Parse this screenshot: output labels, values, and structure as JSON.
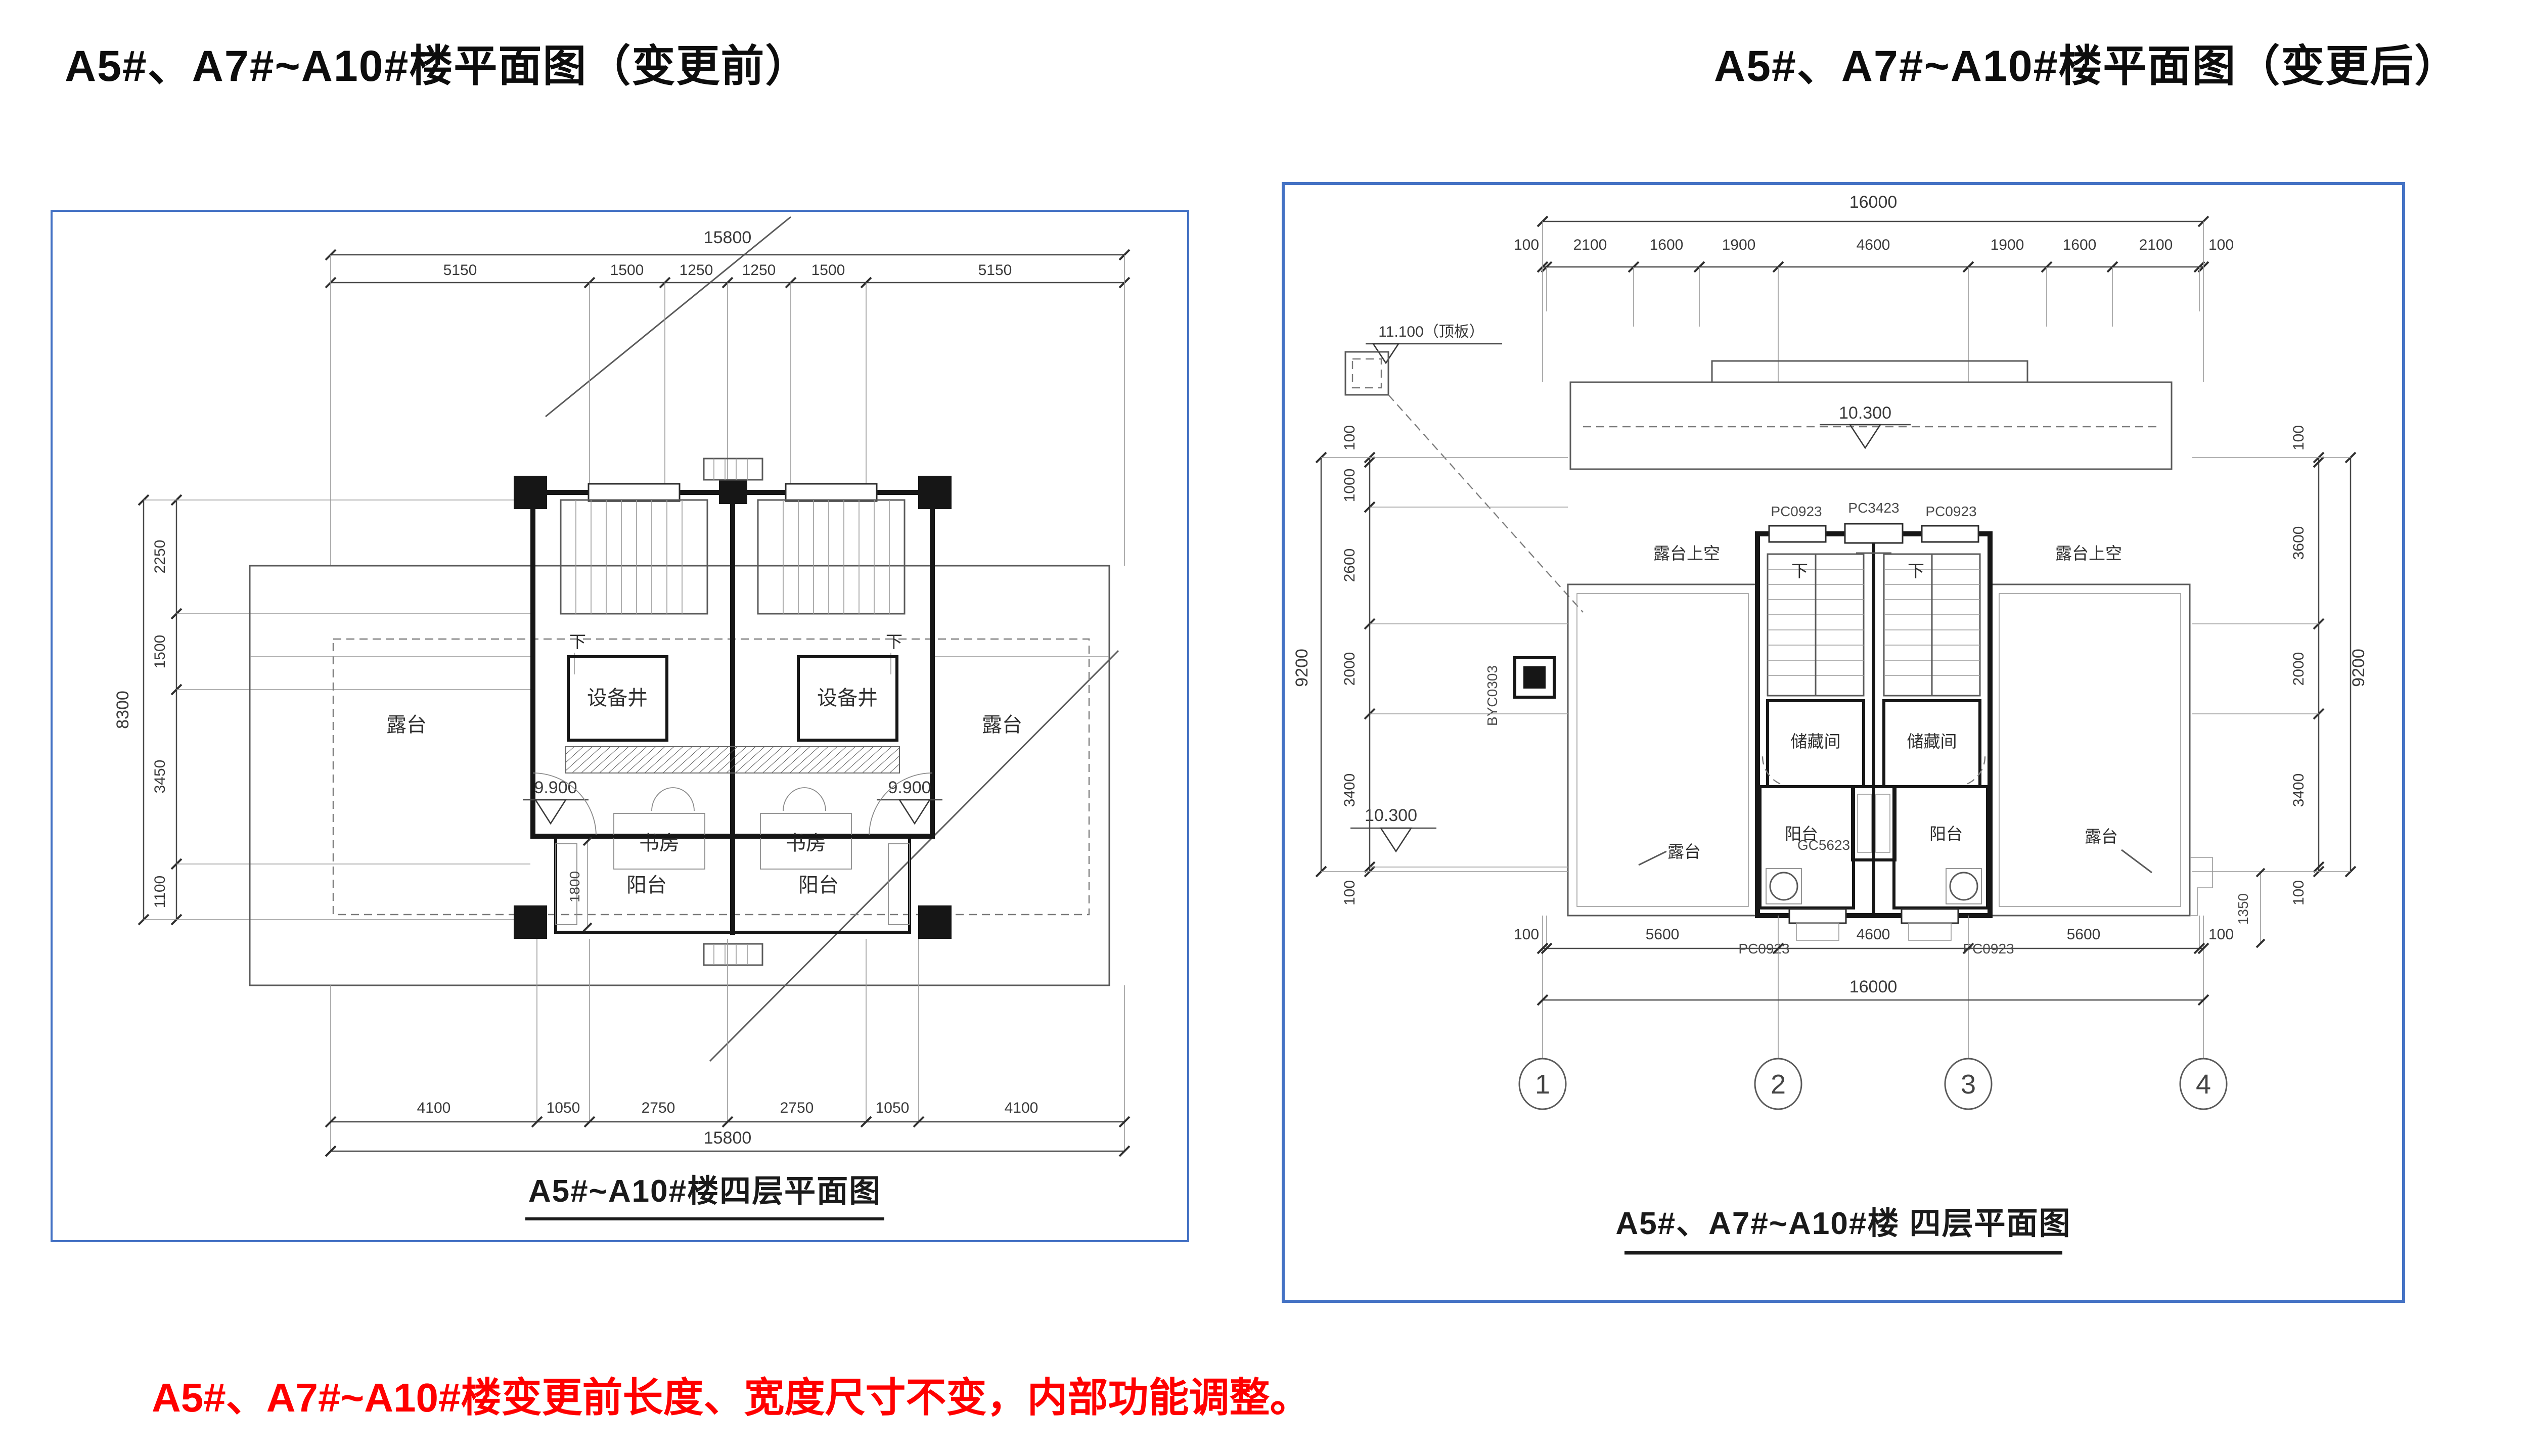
{
  "page": {
    "title_before": "A5#、A7#~A10#楼平面图（变更前）",
    "title_after": "A5#、A7#~A10#楼平面图（变更后）",
    "note": "A5#、A7#~A10#楼变更前长度、宽度尺寸不变，内部功能调整。",
    "note_color": "#ff0000",
    "panel_border_color": "#4472c4"
  },
  "before": {
    "caption": "A5#~A10#楼四层平面图",
    "dims": {
      "top_overall": "15800",
      "top_segments": [
        "5150",
        "1500",
        "1250",
        "1250",
        "1500",
        "5150"
      ],
      "bottom_segments": [
        "4100",
        "1050",
        "2750",
        "2750",
        "1050",
        "4100"
      ],
      "bottom_overall": "15800",
      "left_overall": "8300",
      "left_segments": [
        "2250",
        "1500",
        "3450",
        "1100"
      ],
      "balcony_depth": "1800"
    },
    "levels": {
      "left": "9.900",
      "right": "9.900"
    },
    "rooms": {
      "equipment_shaft": "设备井",
      "study": "书房",
      "balcony": "阳台",
      "terrace": "露台",
      "stair_down": "下"
    }
  },
  "after": {
    "caption": "A5#、A7#~A10#楼 四层平面图",
    "dims": {
      "top_overall": "16000",
      "top_segments": [
        "100",
        "2100",
        "1600",
        "1900",
        "4600",
        "1900",
        "1600",
        "2100",
        "100"
      ],
      "bottom_segments": [
        "100",
        "5600",
        "4600",
        "5600",
        "100"
      ],
      "bottom_overall": "16000",
      "left_overall": "9200",
      "left_segments": [
        "100",
        "1000",
        "2600",
        "2000",
        "3400",
        "100"
      ],
      "right_overall": "9200",
      "right_segments": [
        "100",
        "3600",
        "2000",
        "3400",
        "100"
      ],
      "right_offset": "1350"
    },
    "grid_bubbles": [
      "1",
      "2",
      "3",
      "4"
    ],
    "levels": {
      "roof": "10.300",
      "terrace": "10.300",
      "top_note": "11.100（顶板）"
    },
    "windows": {
      "top": [
        "PC0923",
        "PC3423",
        "PC0923"
      ],
      "bottom": [
        "PC0923",
        "PC0923"
      ],
      "center": "GC5623",
      "wall_tag": "BYC0303"
    },
    "rooms": {
      "storage": "储藏间",
      "balcony": "阳台",
      "terrace": "露台",
      "terrace_sky": "露台上空",
      "stair_down": "下"
    }
  }
}
